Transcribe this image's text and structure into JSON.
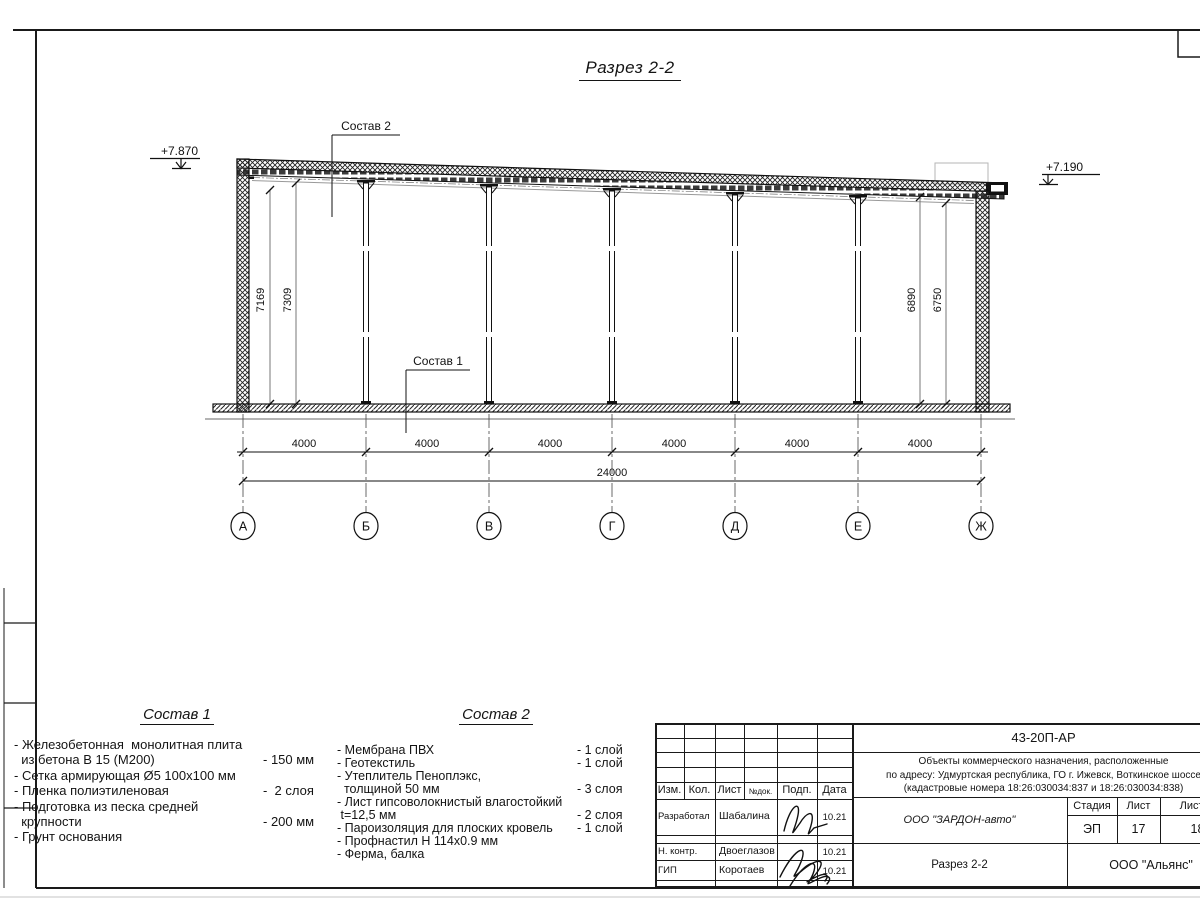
{
  "sheet": {
    "title": "Разрез 2-2"
  },
  "drawing": {
    "elevation_left": "+7.870",
    "elevation_right": "+7.190",
    "label_sostav1": "Состав 1",
    "label_sostav2": "Состав 2",
    "dims_left": [
      "7169",
      "7309"
    ],
    "dims_right": [
      "6890",
      "6750"
    ],
    "span_dims": [
      "4000",
      "4000",
      "4000",
      "4000",
      "4000",
      "4000"
    ],
    "total_dim": "24000",
    "axes": [
      "А",
      "Б",
      "В",
      "Г",
      "Д",
      "Е",
      "Ж"
    ]
  },
  "sostav1": {
    "title": "Состав 1",
    "lines": [
      {
        "t": "- Железобетонная  монолитная плита",
        "v": ""
      },
      {
        "t": "  из бетона В 15 (М200)",
        "v": "- 150 мм"
      },
      {
        "t": "- Сетка армирующая Ø5 100x100 мм",
        "v": ""
      },
      {
        "t": "- Пленка полиэтиленовая",
        "v": "-  2 слоя"
      },
      {
        "t": "- Подготовка из песка средней",
        "v": ""
      },
      {
        "t": "  крупности",
        "v": "- 200 мм"
      },
      {
        "t": "- Грунт основания",
        "v": ""
      }
    ]
  },
  "sostav2": {
    "title": "Состав 2",
    "lines": [
      {
        "t": "- Мембрана ПВХ",
        "v": "- 1 слой"
      },
      {
        "t": "- Геотекстиль",
        "v": "- 1 слой"
      },
      {
        "t": "- Утеплитель Пеноплэкс,",
        "v": ""
      },
      {
        "t": "  толщиной 50 мм",
        "v": "- 3 слоя"
      },
      {
        "t": "- Лист гипсоволокнистый влагостойкий",
        "v": ""
      },
      {
        "t": " t=12,5 мм",
        "v": "- 2 слоя"
      },
      {
        "t": "- Пароизоляция для плоских кровель",
        "v": "- 1 слой"
      },
      {
        "t": "- Профнастил Н 114x0.9 мм",
        "v": ""
      },
      {
        "t": "- Ферма, балка",
        "v": ""
      }
    ]
  },
  "titleblock": {
    "doc_number": "43-20П-АР",
    "project_line1": "Объекты коммерческого назначения, расположенные",
    "project_line2": "по адресу: Удмуртская республика, ГО г. Ижевск, Воткинское шоссе",
    "project_line3": "(кадастровые номера 18:26:030034:837 и 18:26:030034:838)",
    "cols": {
      "izm": "Изм.",
      "kol": "Кол.",
      "list": "Лист",
      "ndok": "№док.",
      "podp": "Подп.",
      "data": "Дата"
    },
    "rows": [
      {
        "role": "Разработал",
        "name": "Шабалина",
        "date": "10.21"
      },
      {
        "role": "",
        "name": "",
        "date": ""
      },
      {
        "role": "Н. контр.",
        "name": "Двоеглазов",
        "date": "10.21"
      },
      {
        "role": "ГИП",
        "name": "Коротаев",
        "date": "10.21"
      }
    ],
    "company": "ООО \"ЗАРДОН-авто\"",
    "sheet_title": "Разрез 2-2",
    "org": "ООО \"Альянс\"",
    "stage_label": "Стадия",
    "sheet_label": "Лист",
    "sheets_label": "Листов",
    "stage": "ЭП",
    "sheet_no": "17",
    "sheets_total": "18"
  }
}
